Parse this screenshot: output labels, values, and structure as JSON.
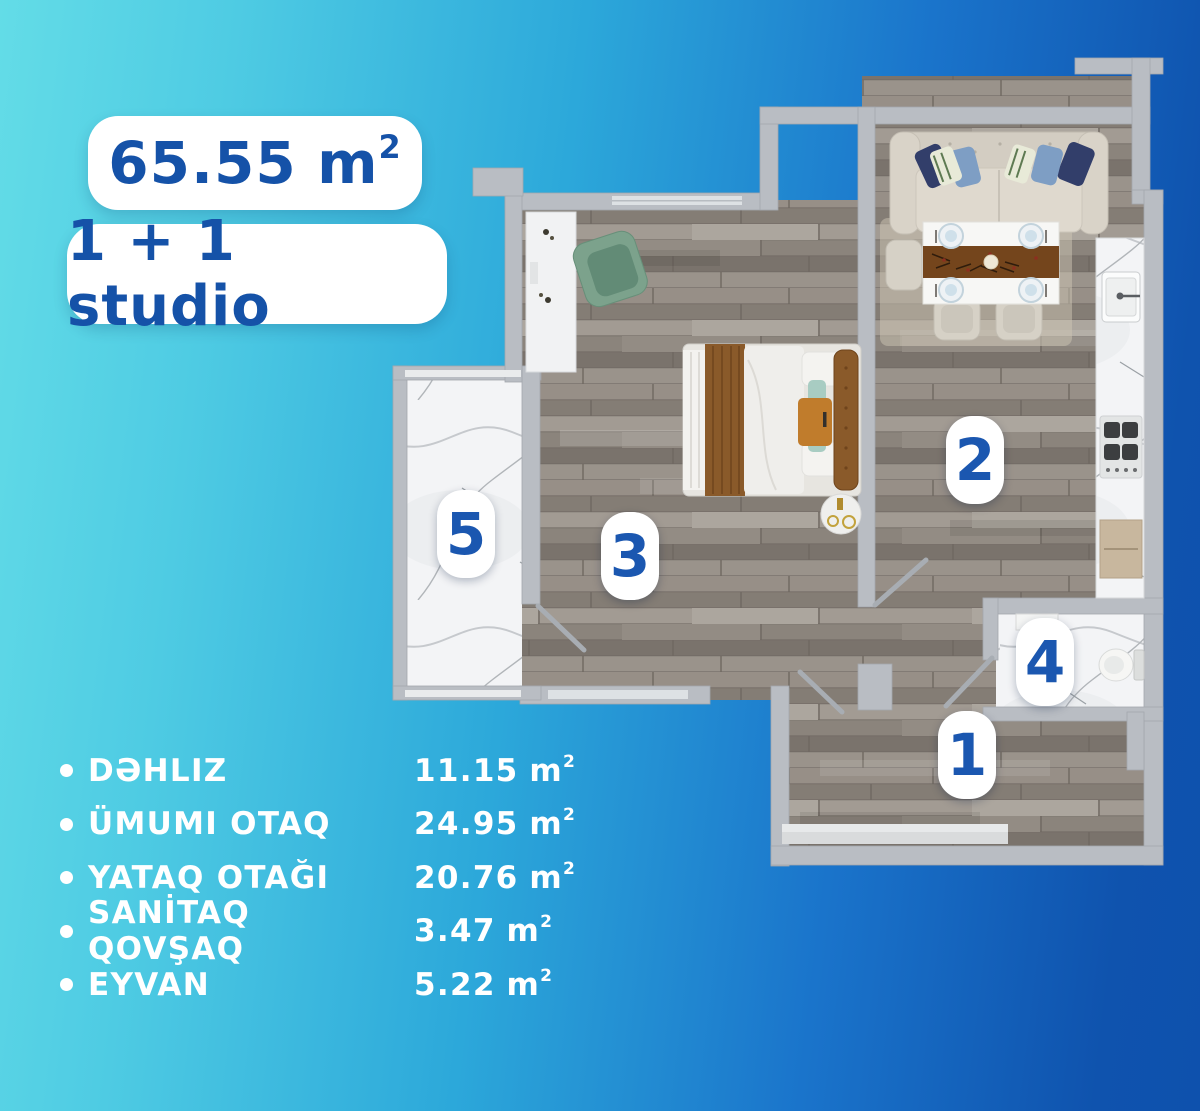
{
  "header": {
    "area_value": "65.55",
    "area_unit": "m",
    "area_sup": "2",
    "type_label": "1 + 1 studio"
  },
  "plan": {
    "markers": [
      {
        "number": "1"
      },
      {
        "number": "2"
      },
      {
        "number": "3"
      },
      {
        "number": "4"
      },
      {
        "number": "5"
      }
    ]
  },
  "legend": {
    "unit": "m",
    "sup": "2",
    "items": [
      {
        "name": "DƏHLIZ",
        "value": "11.15"
      },
      {
        "name": "ÜMUMI OTAQ",
        "value": "24.95"
      },
      {
        "name": "YATAQ OTAĞI",
        "value": "20.76"
      },
      {
        "name": "SANİTAQ QOVŞAQ",
        "value": "3.47"
      },
      {
        "name": "EYVAN",
        "value": "5.22"
      }
    ]
  },
  "colors": {
    "accent_blue": "#1552a8",
    "marker_blue": "#1b57b0",
    "background_start": "#63dce7",
    "background_end": "#0e51ad",
    "wall_gray": "#b9bdc3",
    "wood_floor": "#8d867e",
    "marble_floor": "#f3f4f6"
  }
}
